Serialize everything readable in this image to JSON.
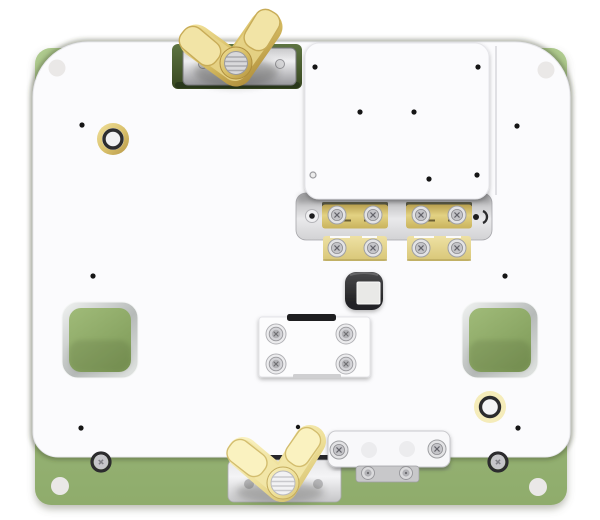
{
  "scene": {
    "kind": "3d-product-render",
    "subject": "PCB test fixture plate assembly",
    "parts": {
      "base_plate": "green base plate",
      "top_plate": "white fixture top plate",
      "wing_nut_top": "brass wing nut clamp (top)",
      "wing_nut_bottom": "brass wing nut clamp (bottom)",
      "dut_plate": "raised white DUT mounting plate",
      "contact_clamps": "brass spring contact clamp bars",
      "socket": "dark center socket with white insert",
      "center_block": "white screwed-down center block",
      "pocket_left": "left square cutout showing base plate",
      "pocket_right": "right square cutout showing base plate",
      "bushing_top_left": "brass guide bushing",
      "bushing_bottom_right": "brass guide bushing",
      "corner_holes": "corner tab clearance holes",
      "dowel_holes": "small black dowel/pin holes"
    }
  },
  "colors": {
    "page_bg": "#ffffff",
    "base_green": "#a1bd7d",
    "base_green_light": "#aeca8e",
    "base_green_dark": "#8fac6c",
    "recess_green": "#36451f",
    "recess_green_light": "#5e7542",
    "plate_white": "#fbfbfd",
    "plate_edge": "#e8e8ec",
    "metal_dark": "#98989c",
    "brass_light": "#f0df96",
    "brass_mid": "#d6bc62",
    "brass_dark": "#b3923f",
    "brass_pale_light": "#f9f1c0",
    "brass_pale_mid": "#eedf97",
    "socket_dark": "#232325",
    "socket_inner": "#e9e9e7",
    "chamfer_light": "#f1f3f2",
    "chamfer_dark": "#b6bab8",
    "cutout_green": "#a0bb79",
    "cutout_green_dark": "#809c5a",
    "hole_black": "#151515",
    "screw_silver": "#c6c6ca",
    "screw_ring_dark": "#2c2c2e"
  }
}
